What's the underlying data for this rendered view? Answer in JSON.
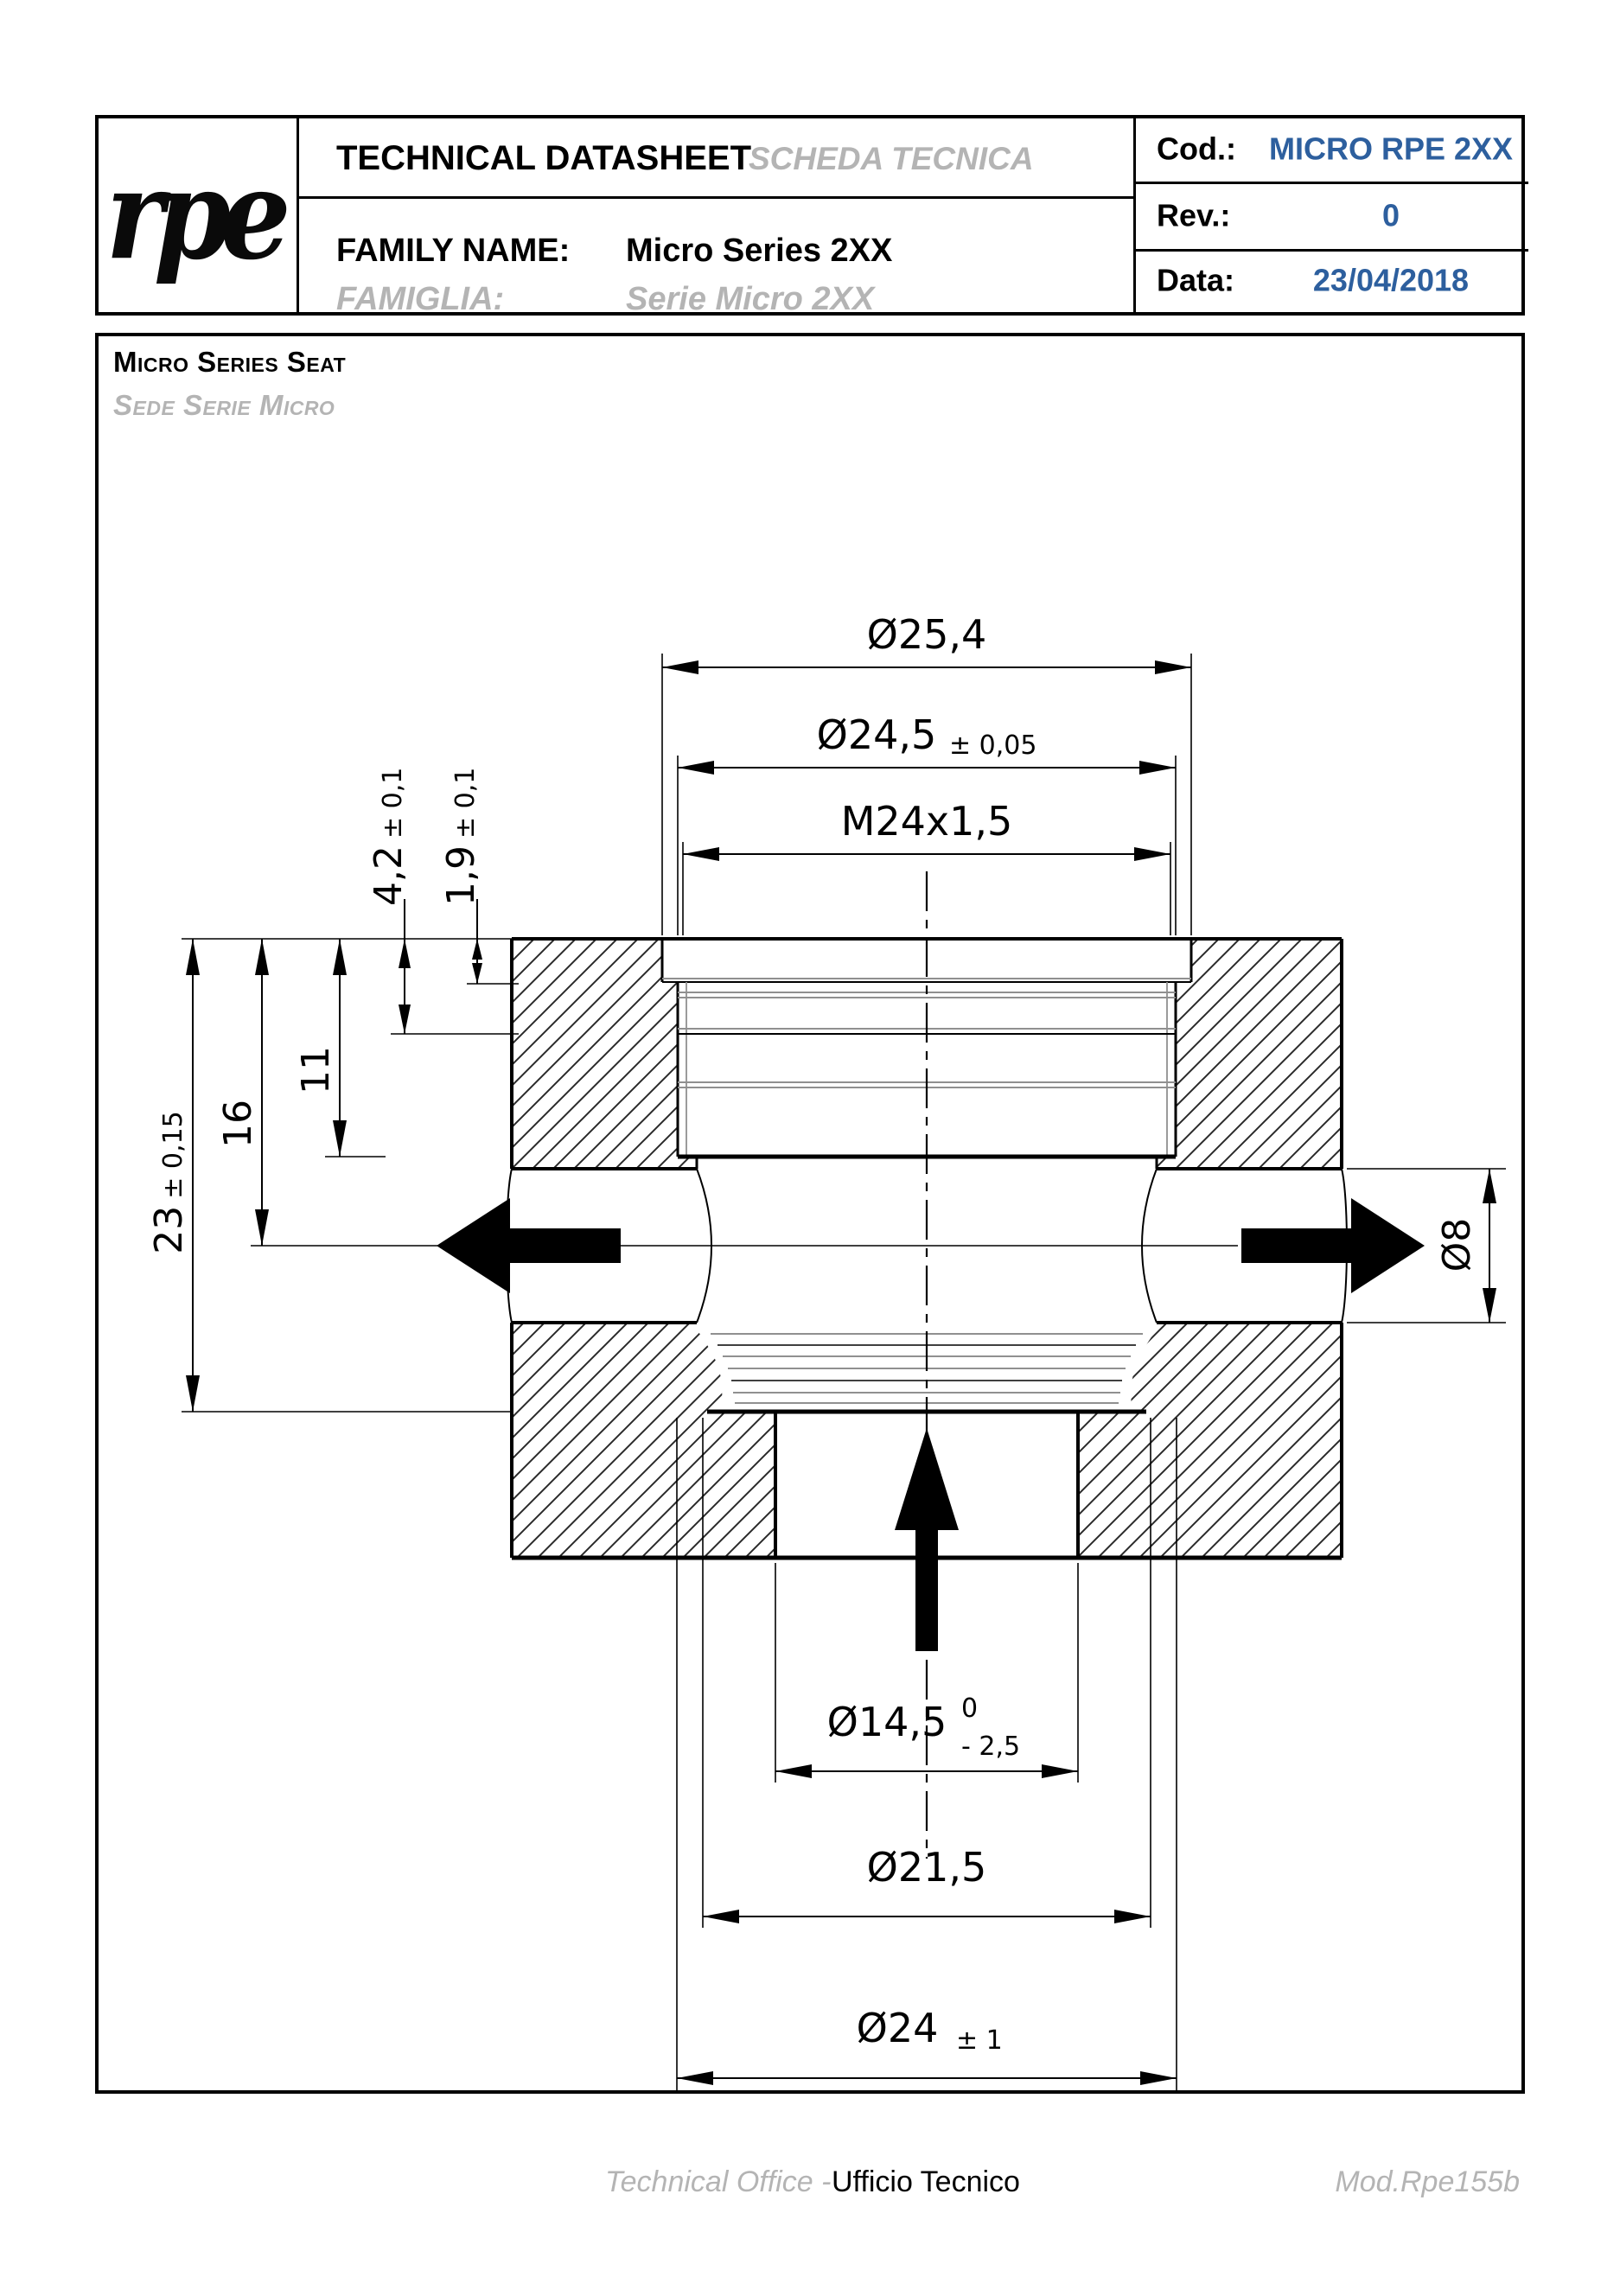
{
  "header": {
    "logo_text": "rpe",
    "title_en": "TECHNICAL DATASHEET",
    "title_it": "SCHEDA TECNICA",
    "family_label_en": "FAMILY NAME:",
    "family_value_en": "Micro Series 2XX",
    "family_label_it": "FAMIGLIA:",
    "family_value_it": "Serie Micro 2XX",
    "cod_label": "Cod.:",
    "cod_value": "MICRO RPE 2XX",
    "rev_label": "Rev.:",
    "rev_value": "0",
    "date_label": "Data:",
    "date_value": "23/04/2018",
    "accent_color": "#2d5f9e"
  },
  "sheet": {
    "title_en": "Micro Series Seat",
    "title_it": "Sede Serie Micro"
  },
  "drawing": {
    "dims": {
      "d25_4": {
        "value": "Ø25,4"
      },
      "d24_5": {
        "value": "Ø24,5",
        "tol": "± 0,05"
      },
      "m24": {
        "value": "M24x1,5"
      },
      "d4_2": {
        "value": "4,2",
        "tol": "± 0,1"
      },
      "d1_9": {
        "value": "1,9",
        "tol": "± 0,1"
      },
      "d11": {
        "value": "11"
      },
      "d16": {
        "value": "16"
      },
      "d23": {
        "value": "23",
        "tol": "± 0,15"
      },
      "d8": {
        "value": "Ø8"
      },
      "d14_5": {
        "value": "Ø14,5",
        "tol_upper": "0",
        "tol_lower": "- 2,5"
      },
      "d21_5": {
        "value": "Ø21,5"
      },
      "d24": {
        "value": "Ø24",
        "tol": "± 1"
      }
    }
  },
  "footer": {
    "office_en": "Technical Office -",
    "office_it": "Ufficio Tecnico",
    "mod": "Mod.Rpe155b"
  }
}
